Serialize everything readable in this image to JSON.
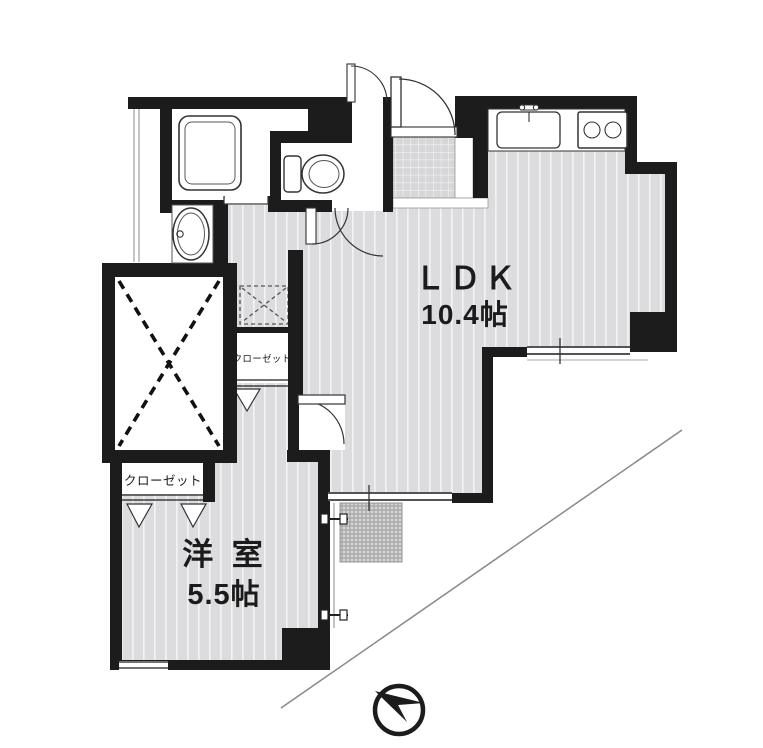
{
  "plan": {
    "ldk": {
      "name": "ＬＤＫ",
      "size": "10.4帖"
    },
    "western_room": {
      "name": "洋 室",
      "size": "5.5帖"
    },
    "closet_main": {
      "label": "クローゼット"
    },
    "closet_hall": {
      "label": "クローゼット"
    }
  },
  "fixtures": {
    "bathtub": "bathtub",
    "wash_basin": "wash-basin",
    "toilet": "toilet",
    "kitchen_sink": "kitchen-sink",
    "gas_stove": "two-burner-stove",
    "washing_machine_space": "washing-machine-space",
    "entrance": "genkan-entrance",
    "void_area": "void-area-x",
    "north_arrow": "north-arrow"
  },
  "colors": {
    "wall": "#1c1c1c",
    "floor": "#dcdcdf",
    "floor_stripe": "#f2f2f4",
    "tile": "#d7d7da",
    "service_hatch": "#9a9a9a",
    "thin_line": "#888888"
  }
}
